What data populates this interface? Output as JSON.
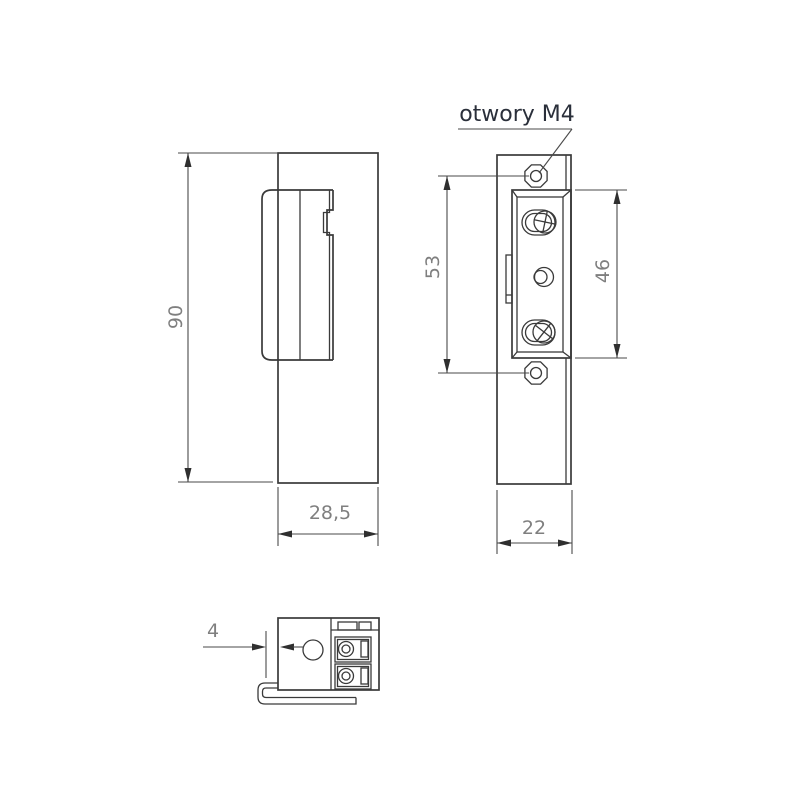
{
  "drawing": {
    "title": "electric-strike-dimensional-drawing",
    "callout": {
      "holes_label": "otwory M4"
    },
    "dimensions": {
      "overall_height": "90",
      "side_width": "28,5",
      "faceplate_width": "22",
      "mount_hole_spacing": "53",
      "screw_spacing": "46",
      "lip_offset": "4"
    },
    "colors": {
      "background": "#ffffff",
      "line": "#3a3a3a",
      "dimension_text": "#7f7f7f",
      "callout_text": "#2a2f3a"
    }
  }
}
